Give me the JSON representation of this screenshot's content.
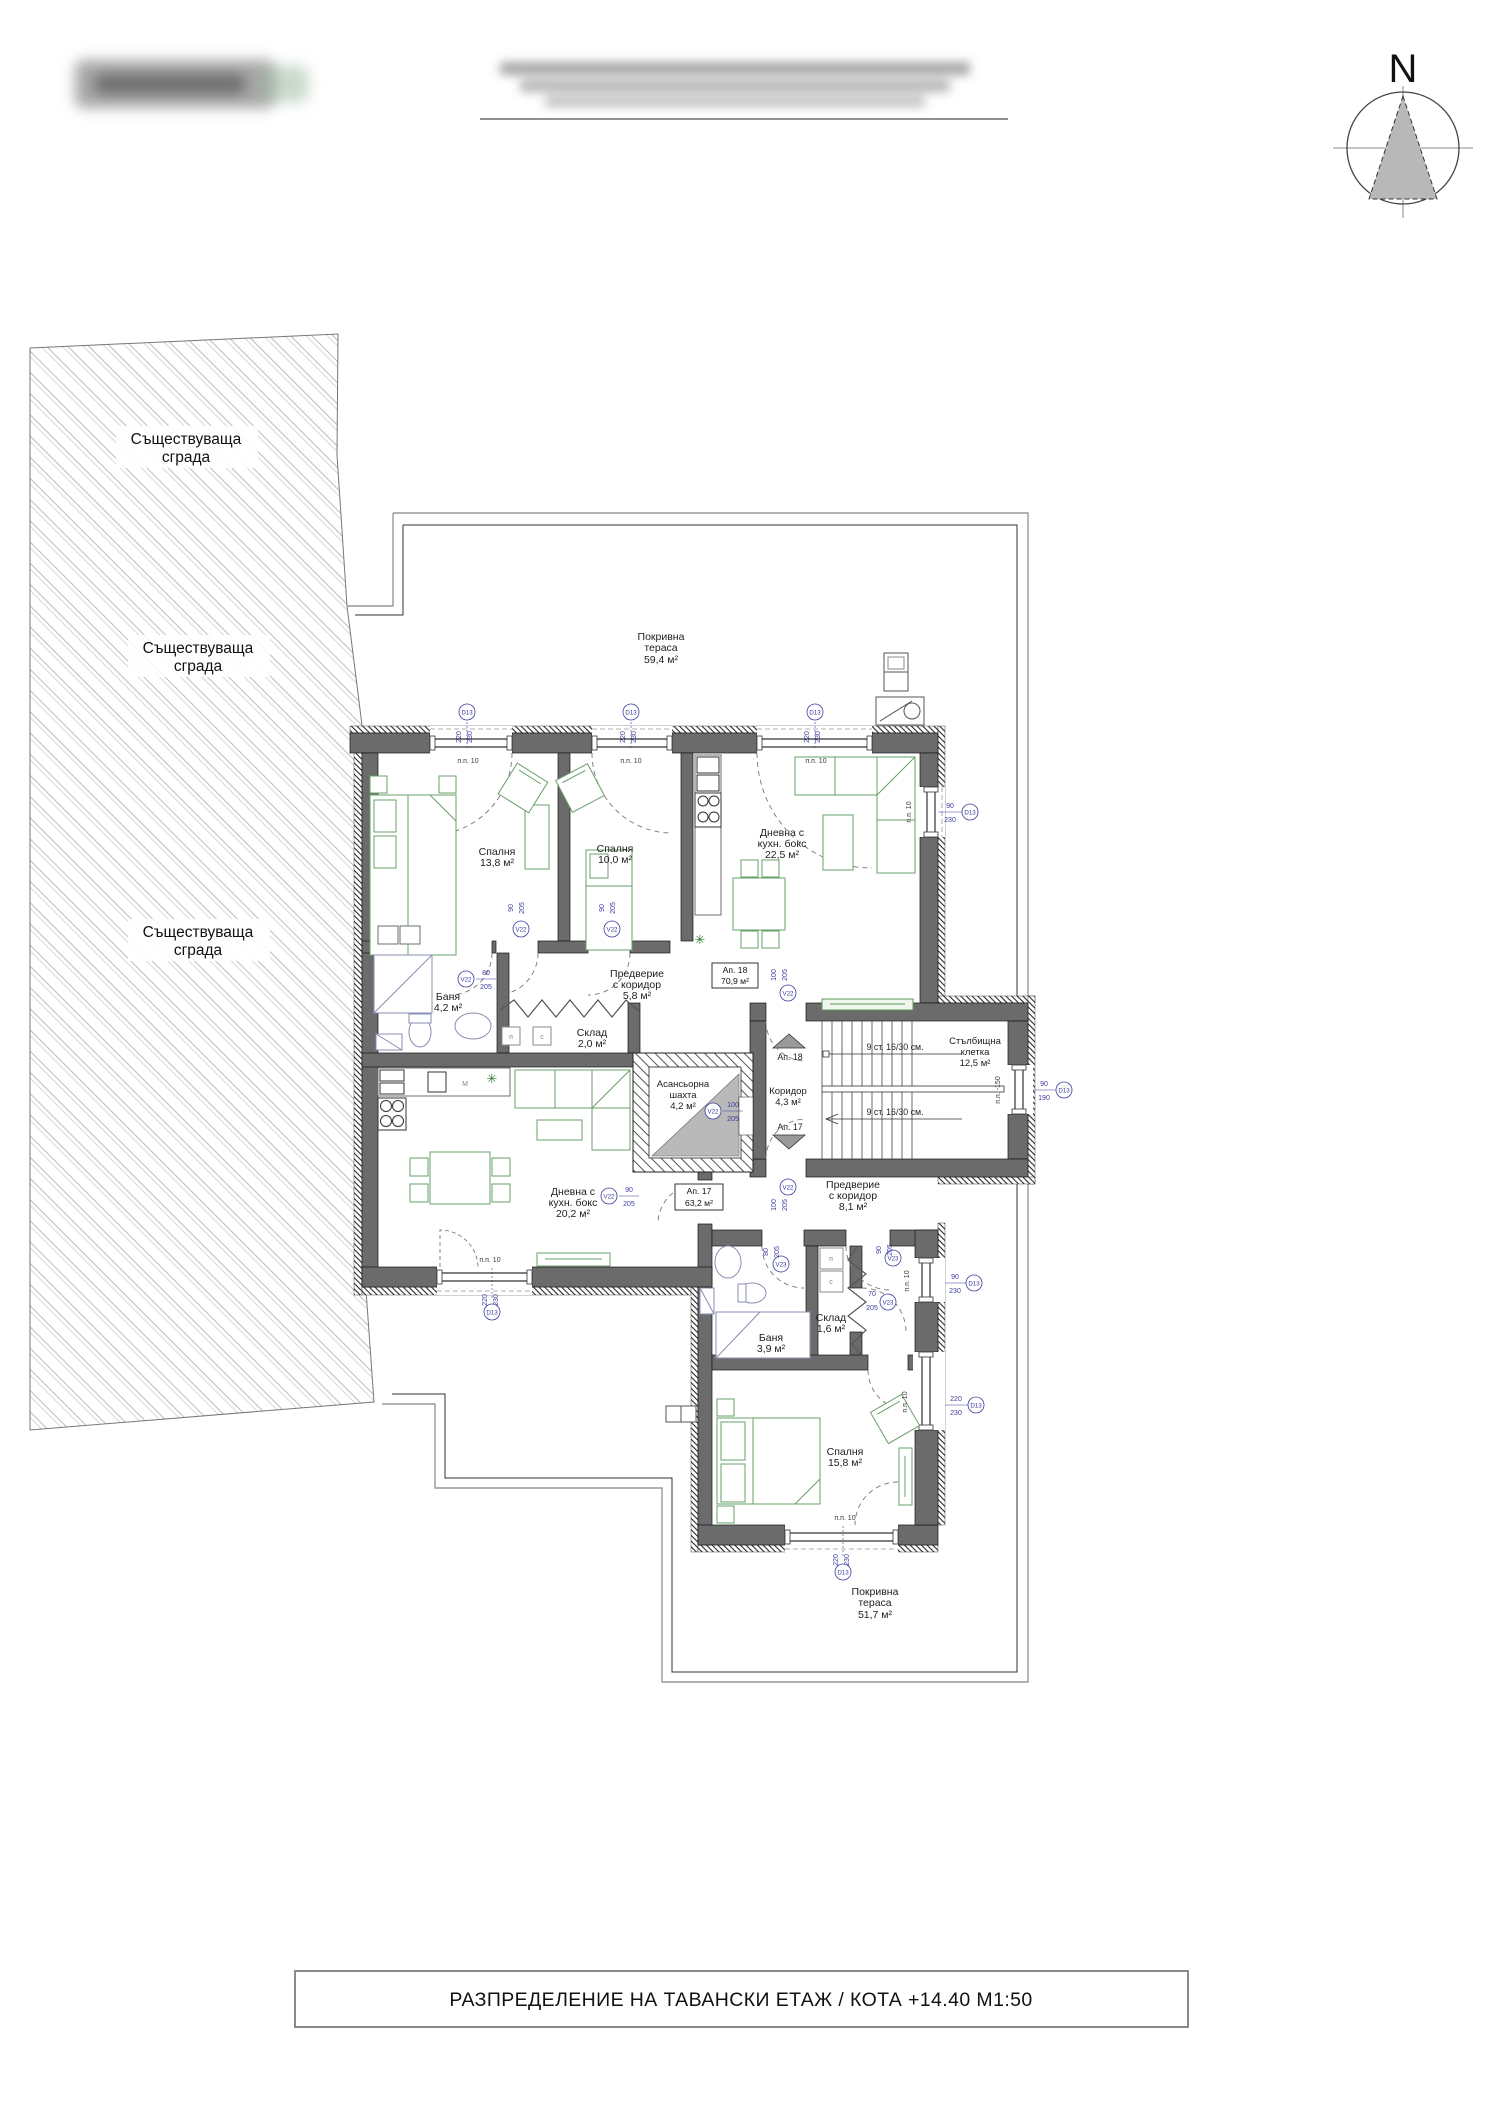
{
  "header": {
    "north_label": "N"
  },
  "existing_building": {
    "line1": "Съществуваща",
    "line2": "сграда"
  },
  "title_bar": {
    "text": "РАЗПРЕДЕЛЕНИЕ НА ТАВАНСКИ ЕТАЖ / КОТА +14.40 М1:50"
  },
  "rooms": {
    "terrace_top": {
      "l1": "Покривна",
      "l2": "тераса",
      "l3": "59,4 м²"
    },
    "terrace_bottom": {
      "l1": "Покривна",
      "l2": "тераса",
      "l3": "51,7 м²"
    },
    "bedroom_13_8": {
      "l1": "Спалня",
      "l2": "13,8 м²"
    },
    "bedroom_10_0": {
      "l1": "Спалня",
      "l2": "10,0 м²"
    },
    "bedroom_15_8": {
      "l1": "Спалня",
      "l2": "15,8 м²"
    },
    "living_22_5": {
      "l1": "Дневна с",
      "l2": "кухн. бокс",
      "l3": "22,5 м²"
    },
    "living_20_2": {
      "l1": "Дневна с",
      "l2": "кухн. бокс",
      "l3": "20,2 м²"
    },
    "hall_5_8": {
      "l1": "Предверие",
      "l2": "с коридор",
      "l3": "5,8 м²"
    },
    "hall_8_1": {
      "l1": "Предверие",
      "l2": "с коридор",
      "l3": "8,1 м²"
    },
    "bath_4_2": {
      "l1": "Баня",
      "l2": "4,2 м²"
    },
    "bath_3_9": {
      "l1": "Баня",
      "l2": "3,9 м²"
    },
    "storage_2_0": {
      "l1": "Склад",
      "l2": "2,0 м²"
    },
    "storage_1_6": {
      "l1": "Склад",
      "l2": "1,6 м²"
    },
    "elevator": {
      "l1": "Асансьорна",
      "l2": "шахта",
      "l3": "4,2 м²"
    },
    "stairwell": {
      "l1": "Стълбищна",
      "l2": "клетка",
      "l3": "12,5 м²"
    },
    "corridor": {
      "l1": "Коридор",
      "l2": "4,3 м²"
    }
  },
  "tags": {
    "ap18": {
      "l1": "Ап. 18",
      "l2": "70,9 м²"
    },
    "ap17": {
      "l1": "Ап. 17",
      "l2": "63,2 м²"
    }
  },
  "stairs": {
    "run_label": "9 ст. 16/30 см.",
    "up_ref": "Ап. 18",
    "down_ref": "Ап. 17"
  },
  "markers": {
    "window_code": "D13",
    "door_code_v22": "V22",
    "door_code_v23": "V23",
    "dims": {
      "w220": "220",
      "h230": "230",
      "w90": "90",
      "h190": "190",
      "h205": "205",
      "w100": "100",
      "w80": "80",
      "w70": "70"
    },
    "parapet_10": "п.п. 10",
    "parapet_minus150": "п.п. -150"
  },
  "appliance_letters": {
    "p": "п",
    "c": "с",
    "m": "М"
  },
  "plant_symbol": "✳"
}
